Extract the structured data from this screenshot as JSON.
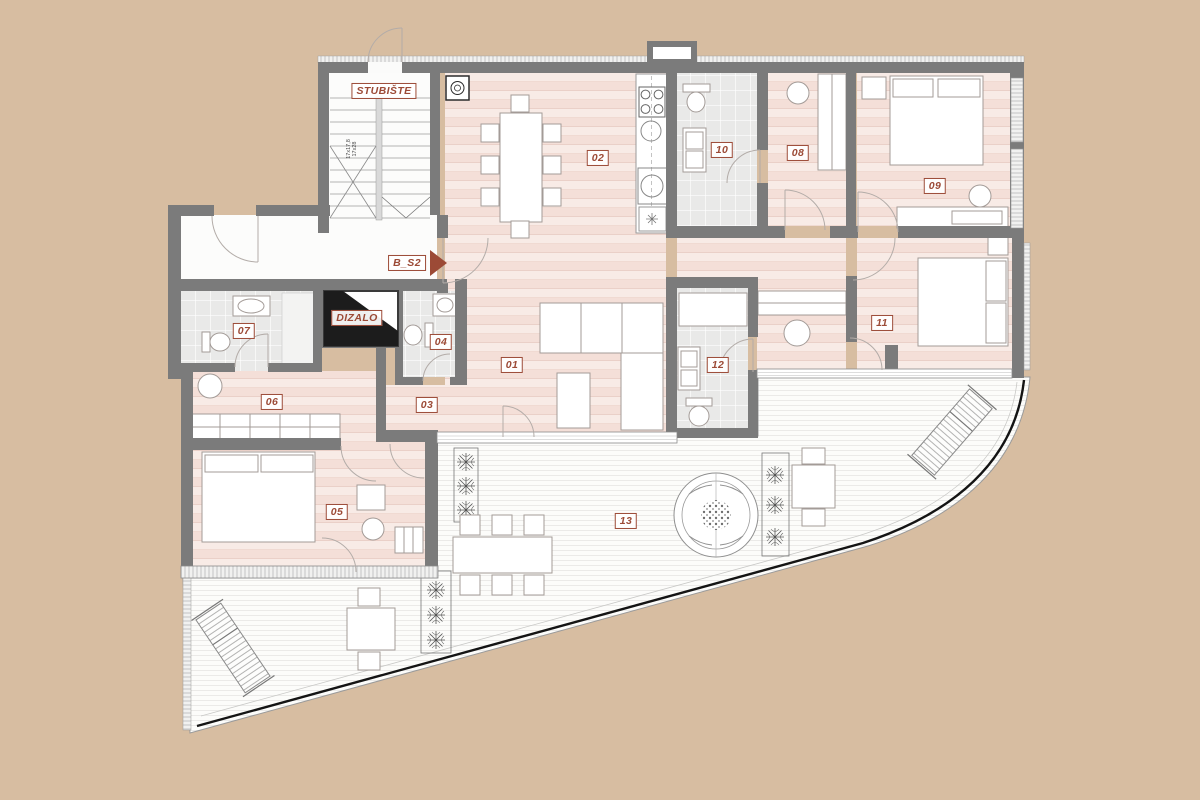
{
  "plan": {
    "title": "apartment-floor-plan",
    "unit_label": "B_S2",
    "colors": {
      "background": "#d7bda1",
      "wall": "#7b7b7b",
      "label_accent": "#9c4a36",
      "floor_pink": "#f6e7e1",
      "bath_tile": "#eaeaea",
      "terrace": "#fcfcfb",
      "railing": "#141414"
    },
    "fixed_labels": {
      "staircase": "STUBIŠTE",
      "elevator": "DIZALO",
      "unit": "B_S2",
      "stair_dim_line1": "17x17,8",
      "stair_dim_line2": "17x28"
    },
    "room_labels": [
      {
        "number": "01",
        "x": 512,
        "y": 365
      },
      {
        "number": "02",
        "x": 598,
        "y": 158
      },
      {
        "number": "03",
        "x": 427,
        "y": 405
      },
      {
        "number": "04",
        "x": 441,
        "y": 342
      },
      {
        "number": "05",
        "x": 337,
        "y": 512
      },
      {
        "number": "06",
        "x": 272,
        "y": 402
      },
      {
        "number": "07",
        "x": 244,
        "y": 331
      },
      {
        "number": "08",
        "x": 798,
        "y": 153
      },
      {
        "number": "09",
        "x": 935,
        "y": 186
      },
      {
        "number": "10",
        "x": 722,
        "y": 150
      },
      {
        "number": "11",
        "x": 882,
        "y": 323
      },
      {
        "number": "12",
        "x": 718,
        "y": 365
      },
      {
        "number": "13",
        "x": 626,
        "y": 521
      }
    ],
    "positions": {
      "staircase_label": {
        "x": 384,
        "y": 91
      },
      "elevator_label": {
        "x": 357,
        "y": 318
      },
      "unit_label": {
        "x": 407,
        "y": 263
      },
      "stair_dim": {
        "x": 352,
        "y": 149
      }
    }
  }
}
